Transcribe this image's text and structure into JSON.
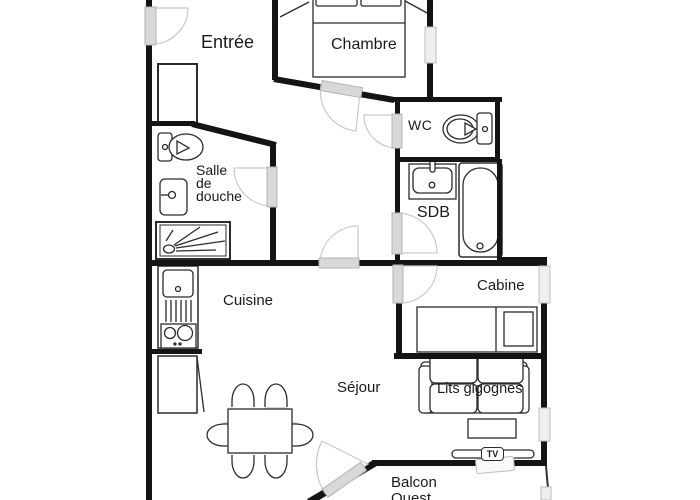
{
  "title": "Apartment floor plan",
  "rooms": {
    "entree": {
      "label": "Entrée"
    },
    "chambre": {
      "label": "Chambre"
    },
    "wc": {
      "label": "WC"
    },
    "sdb": {
      "label": "SDB"
    },
    "salle_de_douche": {
      "label_line1": "Salle",
      "label_line2": "de",
      "label_line3": "douche"
    },
    "cuisine": {
      "label": "Cuisine"
    },
    "cabine": {
      "label": "Cabine"
    },
    "sejour": {
      "label": "Séjour"
    },
    "balcon": {
      "label_line1": "Balcon",
      "label_line2": "Ouest"
    }
  },
  "furniture": {
    "lits_gigognes_label": "Lits gigognes",
    "tv_label": "TV"
  },
  "fixtures": {
    "chambre": [
      "double-bed"
    ],
    "wc": [
      "toilet"
    ],
    "salle_de_douche": [
      "toilet",
      "washbasin",
      "shower-tray"
    ],
    "sdb": [
      "washbasin",
      "bathtub"
    ],
    "cuisine": [
      "sink-unit",
      "hob",
      "fridge"
    ],
    "sejour": [
      "dining-table",
      "six-chairs"
    ],
    "cabine": [
      "single-bed"
    ],
    "tv_area": [
      "sofa-bed",
      "coffee-table",
      "tv-stand"
    ]
  },
  "colors": {
    "wall": "#141414",
    "door": "#d8d8d8",
    "window": "#eeeeee",
    "line": "#2b2b2b",
    "background": "#ffffff"
  }
}
